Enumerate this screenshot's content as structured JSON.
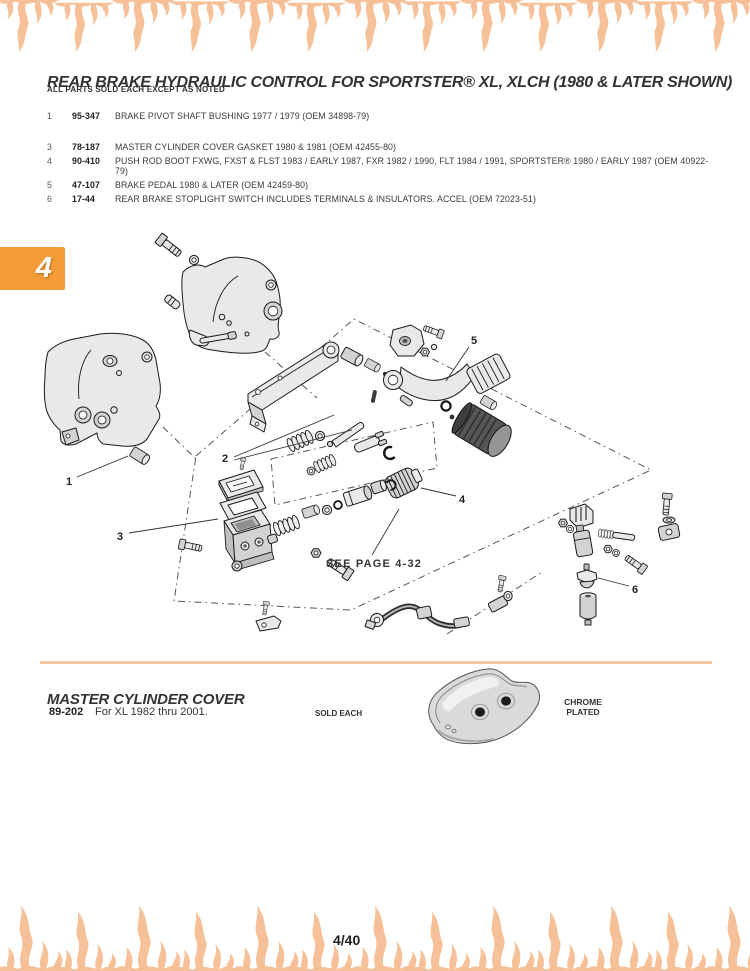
{
  "header": {
    "title": "REAR BRAKE HYDRAULIC CONTROL FOR SPORTSTER® XL, XLCH (1980 & LATER SHOWN)",
    "note": "ALL PARTS SOLD EACH EXCEPT AS NOTED",
    "chapter_tab": "4"
  },
  "parts_list": [
    {
      "ref": "1",
      "part_number": "95-347",
      "description": "BRAKE PIVOT SHAFT BUSHING 1977 / 1979 (OEM 34898-79)"
    },
    {
      "ref": "3",
      "part_number": "78-187",
      "description": "MASTER CYLINDER COVER GASKET 1980 & 1981 (OEM 42455-80)"
    },
    {
      "ref": "4",
      "part_number": "90-410",
      "description": "PUSH ROD BOOT FXWG, FXST & FLST 1983 / EARLY 1987, FXR 1982 / 1990, FLT 1984 / 1991, SPORTSTER® 1980 / EARLY 1987 (OEM 40922-79)"
    },
    {
      "ref": "5",
      "part_number": "47-107",
      "description": "BRAKE PEDAL 1980 & LATER (OEM 42459-80)"
    },
    {
      "ref": "6",
      "part_number": "17-44",
      "description": "REAR BRAKE STOPLIGHT SWITCH INCLUDES TERMINALS & INSULATORS. ACCEL (OEM 72023-51)"
    }
  ],
  "diagram": {
    "callouts": [
      "1",
      "2",
      "3",
      "4",
      "5",
      "6"
    ],
    "note": "SEE PAGE 4-32"
  },
  "master_cylinder_cover": {
    "heading": "MASTER CYLINDER COVER",
    "part_number": "89-202",
    "description": "For XL 1982 thru 2001.",
    "availability": "SOLD EACH",
    "finish": "CHROME PLATED"
  },
  "footer": {
    "page_number": "4/40"
  },
  "colors": {
    "accent_orange": "#F49B37",
    "flame_peach": "#F5BE92",
    "divider_tan": "#F2C79E",
    "text_dark": "#2E2E2E"
  }
}
